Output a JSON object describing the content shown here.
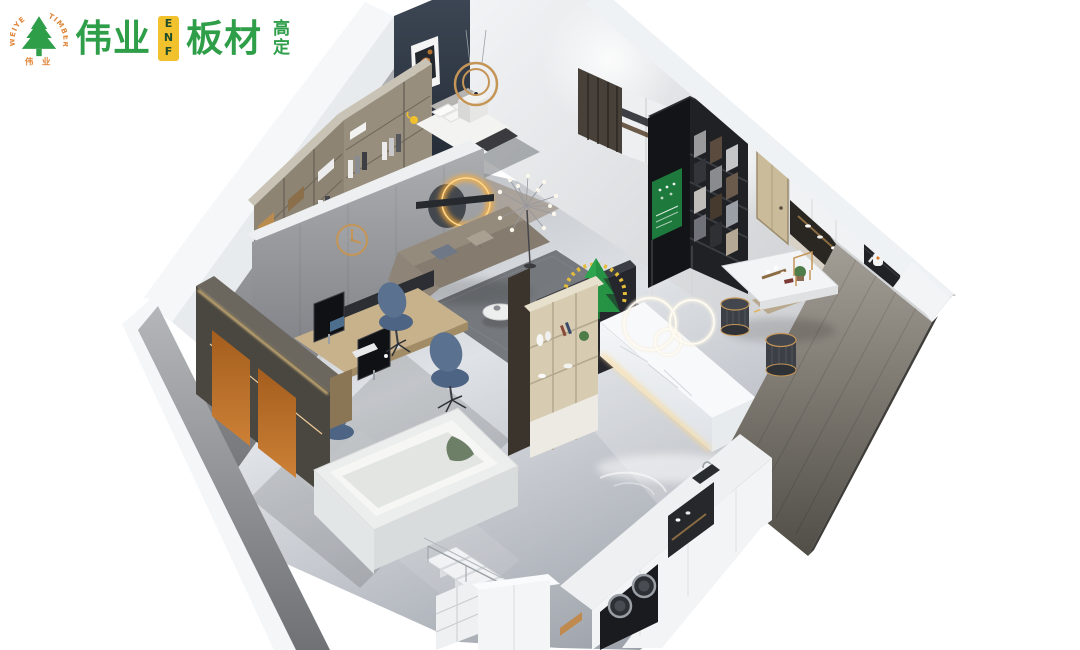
{
  "page": {
    "width": 1080,
    "height": 650,
    "background": "#ffffff"
  },
  "logo": {
    "arc_text_left": "WEIYE",
    "arc_text_right": "TIMBER",
    "badge_caption": "伟 业",
    "wordmark_first": "伟业",
    "cert_tag": "ENF",
    "wordmark_second": "板材",
    "suffix_vertical": "高定",
    "colors": {
      "green": "#2f9e49",
      "orange": "#e0873c",
      "yellow": "#f2c12e",
      "tag_text": "#1d4d2a"
    }
  },
  "scene": {
    "kind": "isometric-interior-3d-render",
    "areas": [
      "bedroom-with-walk-in-closet",
      "office-workstation",
      "lounge-seating-area",
      "reception-and-material-display",
      "kitchen-and-bar",
      "laundry-and-staircase"
    ],
    "colors": {
      "bg": "#ffffff",
      "white": "#f4f5f6",
      "marble": "#f8f9fb",
      "wallOuter": "#f3f5f7",
      "wallNavy": "#2e3845",
      "wallGray": "#9fa1a5",
      "woodTaupe": "#8d8474",
      "woodTaupeLight": "#c9c3b6",
      "woodOak": "#c8b28c",
      "woodOakDark": "#a28c66",
      "woodSlat": "#48413a",
      "woodDoor": "#cabb9a",
      "cabinetDark": "#4a4740",
      "cabinetBlack": "#1e2024",
      "panelOrange": "#b06a28",
      "sofaTaupe": "#958b7d",
      "sofaSeat": "#857c6f",
      "chairBlue": "#5a7190",
      "rugGray": "#63666b",
      "stoolDark": "#3c4046",
      "posterGreen": "#1e7a3c",
      "treeGreen": "#2da44e",
      "blanketGreen": "#6d7f66",
      "metalGold": "#c49557",
      "ledWarm": "#ffd98e",
      "glowAmber": "#ffae36"
    }
  }
}
